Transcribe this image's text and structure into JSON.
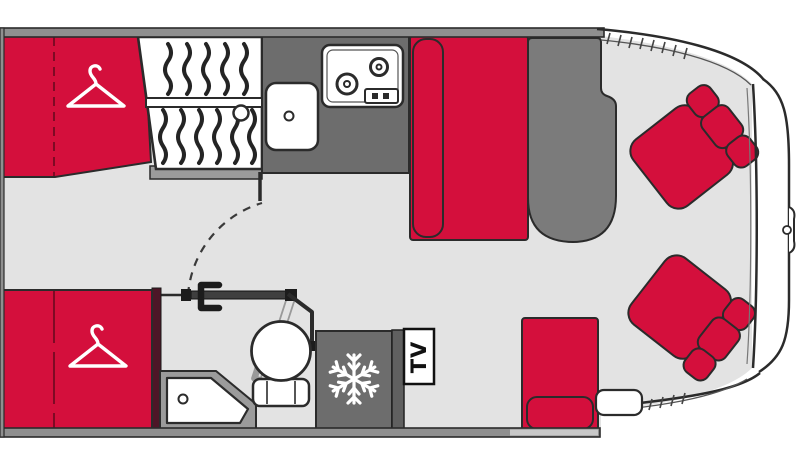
{
  "floorplan": {
    "title": "motorhome floor plan (top view, cab at right)",
    "tv_label": "TV",
    "colors": {
      "upholstery_red": "#d40f3c",
      "counter_gray": "#6d6d6d",
      "table_gray": "#7b7b7b",
      "floor_gray": "#e3e3e3",
      "wall_gray": "#8f8f8f",
      "sill_gray": "#9b9b9b",
      "partition_dark_red": "#4d1627",
      "outline": "#2b2b2b",
      "ghost_gray": "#9a9a9a",
      "white": "#ffffff"
    },
    "icons": [
      {
        "name": "hanger-icon",
        "glyph": "clothes-hanger outline",
        "locations": [
          "rear-wardrobe-top",
          "rear-wardrobe-bottom"
        ]
      },
      {
        "name": "snowflake-icon",
        "glyph": "six-spoke snowflake",
        "location": "fridge"
      },
      {
        "name": "drain-icon",
        "glyph": "small circle",
        "locations": [
          "kitchen-sink",
          "corner-washbasin",
          "shower"
        ]
      }
    ],
    "areas": [
      "rear-wardrobe-top",
      "rear-wardrobe-bottom",
      "shower-cabinet",
      "kitchen-counter",
      "kitchen-sink",
      "two-burner-hob",
      "swing-door",
      "toilet",
      "corner-washbasin",
      "fridge",
      "tv-cabinet",
      "dinette-bench",
      "side-seat",
      "dinette-table",
      "cab-seat-upper",
      "cab-seat-lower",
      "entry-step",
      "cab-windshield"
    ]
  }
}
